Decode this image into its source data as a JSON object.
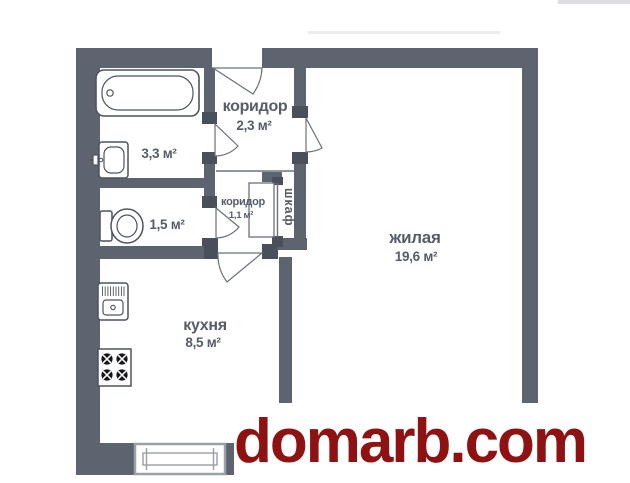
{
  "plan": {
    "type": "apartment-floor-plan",
    "rooms": [
      {
        "id": "bathroom",
        "name": "",
        "area_label": "3,3 м²"
      },
      {
        "id": "corridor-main",
        "name": "коридор",
        "area_label": "2,3 м²"
      },
      {
        "id": "toilet",
        "name": "",
        "area_label": "1,5 м²"
      },
      {
        "id": "corridor-small",
        "name": "коридор",
        "area_label": "1,1 м²"
      },
      {
        "id": "closet",
        "name": "шкаф",
        "area_label": ""
      },
      {
        "id": "living-room",
        "name": "жилая",
        "area_label": "19,6 м²"
      },
      {
        "id": "kitchen",
        "name": "кухня",
        "area_label": "8,5 м²"
      }
    ],
    "fixtures": [
      "bathtub",
      "washbasin",
      "toilet-bowl",
      "kitchen-sink",
      "stove",
      "window"
    ],
    "colors": {
      "wall": "#5d6470",
      "door-jamb": "#49505b",
      "fixture-line": "#4d545f",
      "label-text": "#565d69",
      "watermark-red": "#8e1212"
    }
  },
  "watermark": {
    "text": "domarb.com"
  }
}
